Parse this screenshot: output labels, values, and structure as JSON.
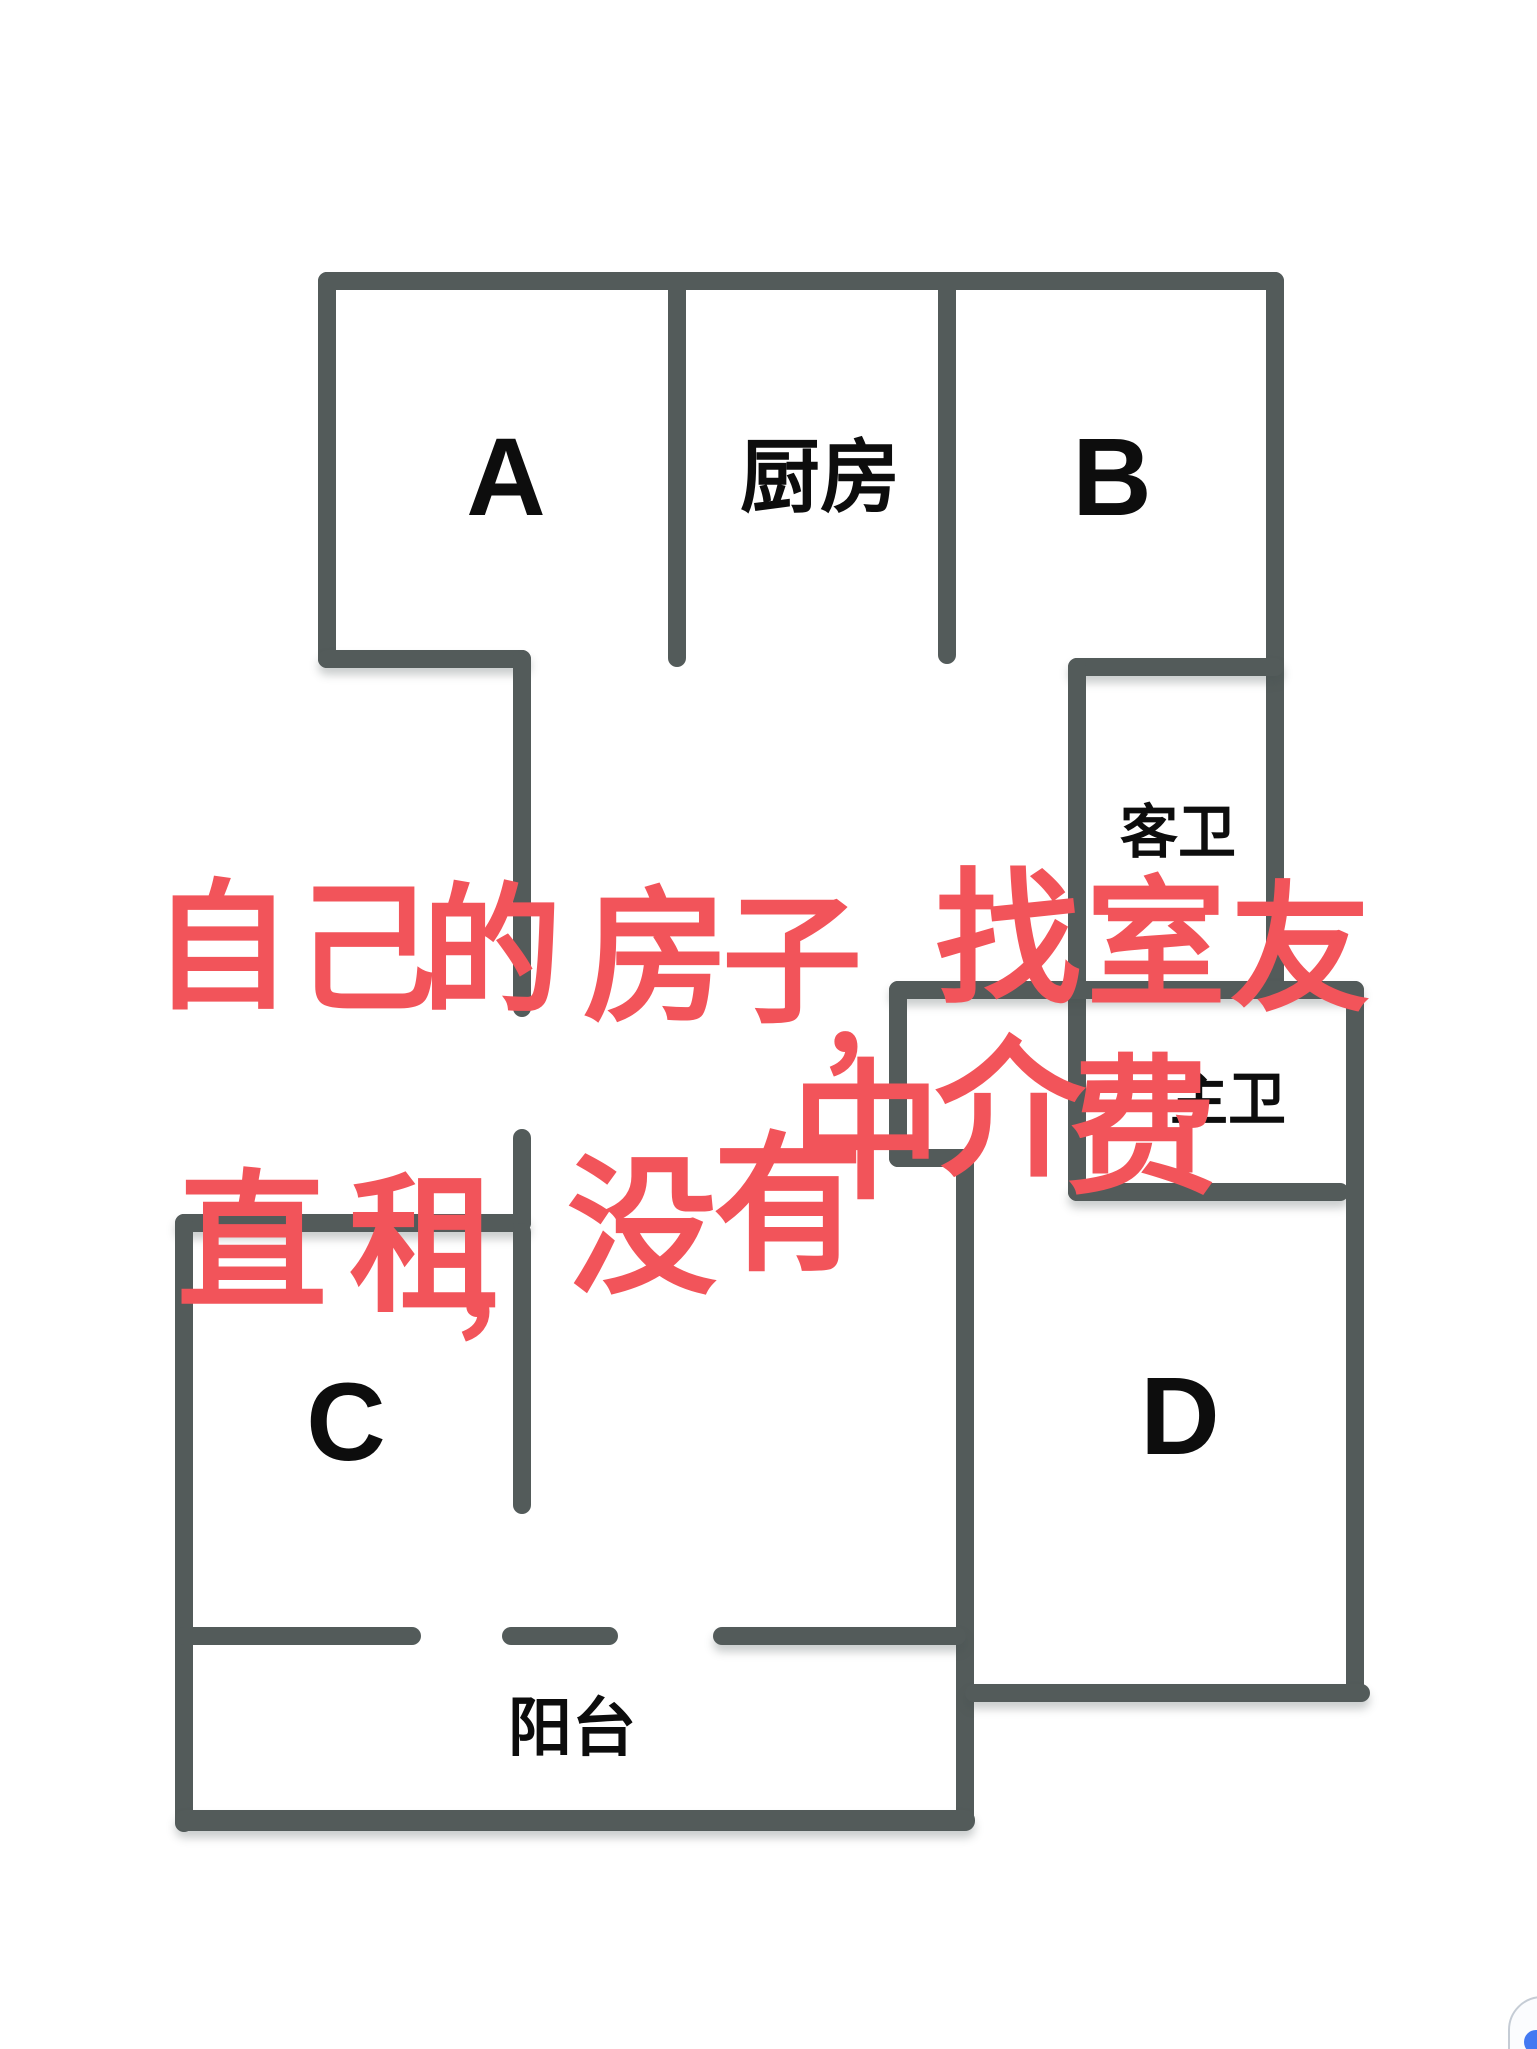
{
  "page": {
    "background": "#ffffff",
    "wall_color": "#535b5a",
    "label_color": "#0d0d0d",
    "note_color": "#f2545a"
  },
  "floorplan": {
    "rooms": [
      {
        "id": "room-a",
        "label": "A",
        "x": 506,
        "y": 478,
        "size": 110
      },
      {
        "id": "kitchen",
        "label": "厨房",
        "x": 820,
        "y": 478,
        "size": 80
      },
      {
        "id": "room-b",
        "label": "B",
        "x": 1112,
        "y": 478,
        "size": 110
      },
      {
        "id": "guest-bathroom",
        "label": "客卫",
        "x": 1178,
        "y": 833,
        "size": 58
      },
      {
        "id": "master-bathroom",
        "label": "主卫",
        "x": 1228,
        "y": 1100,
        "size": 58
      },
      {
        "id": "room-c",
        "label": "C",
        "x": 346,
        "y": 1423,
        "size": 110
      },
      {
        "id": "room-d",
        "label": "D",
        "x": 1180,
        "y": 1417,
        "size": 110
      },
      {
        "id": "balcony",
        "label": "阳台",
        "x": 572,
        "y": 1728,
        "size": 64
      }
    ],
    "walls": [
      {
        "name": "outer-top-wall",
        "x": 318,
        "y": 272,
        "w": 966,
        "h": 18,
        "shadow": false
      },
      {
        "name": "room-a-left-wall",
        "x": 318,
        "y": 272,
        "w": 18,
        "h": 396,
        "shadow": false
      },
      {
        "name": "room-a-bottom-step-wall",
        "x": 318,
        "y": 650,
        "w": 213,
        "h": 18,
        "shadow": true
      },
      {
        "name": "hallway-left-wall-upper",
        "x": 513,
        "y": 650,
        "w": 18,
        "h": 367,
        "shadow": false
      },
      {
        "name": "divider-a-kitchen",
        "x": 668,
        "y": 272,
        "w": 18,
        "h": 395,
        "shadow": false
      },
      {
        "name": "divider-kitchen-b",
        "x": 938,
        "y": 272,
        "w": 18,
        "h": 392,
        "shadow": false
      },
      {
        "name": "outer-right-wall-upper",
        "x": 1266,
        "y": 272,
        "w": 18,
        "h": 730,
        "shadow": false
      },
      {
        "name": "guest-bath-top-wall",
        "x": 1068,
        "y": 658,
        "w": 216,
        "h": 18,
        "shadow": true
      },
      {
        "name": "bath-left-wall",
        "x": 1068,
        "y": 658,
        "w": 18,
        "h": 543,
        "shadow": false
      },
      {
        "name": "hallway-top-wall",
        "x": 889,
        "y": 981,
        "w": 475,
        "h": 18,
        "shadow": true
      },
      {
        "name": "hallway-nook-left-wall",
        "x": 889,
        "y": 981,
        "w": 18,
        "h": 186,
        "shadow": false
      },
      {
        "name": "hallway-nook-jog-wall",
        "x": 889,
        "y": 1149,
        "w": 85,
        "h": 18,
        "shadow": false
      },
      {
        "name": "room-d-left-wall",
        "x": 956,
        "y": 1149,
        "w": 18,
        "h": 681,
        "shadow": false
      },
      {
        "name": "master-bath-bottom-wall",
        "x": 1068,
        "y": 1183,
        "w": 281,
        "h": 18,
        "shadow": true
      },
      {
        "name": "outer-right-wall-lower",
        "x": 1346,
        "y": 981,
        "w": 18,
        "h": 721,
        "shadow": false
      },
      {
        "name": "room-d-bottom-wall",
        "x": 965,
        "y": 1684,
        "w": 405,
        "h": 18,
        "shadow": true
      },
      {
        "name": "room-c-top-wall",
        "x": 175,
        "y": 1214,
        "w": 356,
        "h": 18,
        "shadow": true
      },
      {
        "name": "room-c-left-wall",
        "x": 175,
        "y": 1214,
        "w": 18,
        "h": 618,
        "shadow": false
      },
      {
        "name": "hallway-left-wall-lower",
        "x": 513,
        "y": 1129,
        "w": 18,
        "h": 103,
        "shadow": false
      },
      {
        "name": "room-c-right-wall",
        "x": 513,
        "y": 1223,
        "w": 18,
        "h": 291,
        "shadow": false
      },
      {
        "name": "balcony-window-dash-1",
        "x": 175,
        "y": 1627,
        "w": 246,
        "h": 18,
        "shadow": false
      },
      {
        "name": "balcony-window-dash-2",
        "x": 502,
        "y": 1627,
        "w": 116,
        "h": 18,
        "shadow": false
      },
      {
        "name": "balcony-window-dash-3",
        "x": 713,
        "y": 1627,
        "w": 253,
        "h": 18,
        "shadow": true
      },
      {
        "name": "balcony-bottom-wall",
        "x": 175,
        "y": 1810,
        "w": 800,
        "h": 21,
        "shadow": true
      }
    ]
  },
  "note": {
    "full_text": "自己的房子，找室友直租，没有中介费",
    "lines": [
      {
        "text": "自己的房子，找室友",
        "chars": [
          {
            "ch": "自",
            "x": 222,
            "y": 948,
            "size": 140
          },
          {
            "ch": "己",
            "x": 366,
            "y": 950,
            "size": 140
          },
          {
            "ch": "的",
            "x": 492,
            "y": 952,
            "size": 140
          },
          {
            "ch": "房",
            "x": 656,
            "y": 958,
            "size": 146
          },
          {
            "ch": "子",
            "x": 792,
            "y": 962,
            "size": 140
          },
          {
            "ch": "，",
            "x": 876,
            "y": 1020,
            "size": 120
          },
          {
            "ch": "找",
            "x": 1008,
            "y": 940,
            "size": 146
          },
          {
            "ch": "室",
            "x": 1156,
            "y": 945,
            "size": 140
          },
          {
            "ch": "友",
            "x": 1300,
            "y": 950,
            "size": 140
          }
        ]
      },
      {
        "text": "直租，没有中介费",
        "chars": [
          {
            "ch": "直",
            "x": 252,
            "y": 1243,
            "size": 150
          },
          {
            "ch": "租",
            "x": 424,
            "y": 1246,
            "size": 150
          },
          {
            "ch": "，",
            "x": 508,
            "y": 1285,
            "size": 120
          },
          {
            "ch": "没",
            "x": 642,
            "y": 1228,
            "size": 150
          },
          {
            "ch": "有",
            "x": 788,
            "y": 1205,
            "size": 150
          },
          {
            "ch": "中",
            "x": 866,
            "y": 1133,
            "size": 150
          },
          {
            "ch": "介",
            "x": 1010,
            "y": 1110,
            "size": 150
          },
          {
            "ch": "费",
            "x": 1142,
            "y": 1128,
            "size": 150
          }
        ]
      }
    ]
  },
  "corner_widget": {
    "x": 1508,
    "y": 1996,
    "border_color": "#c5ccd5",
    "fill": "#fbfcfe",
    "accent_color": "#4379f2"
  }
}
